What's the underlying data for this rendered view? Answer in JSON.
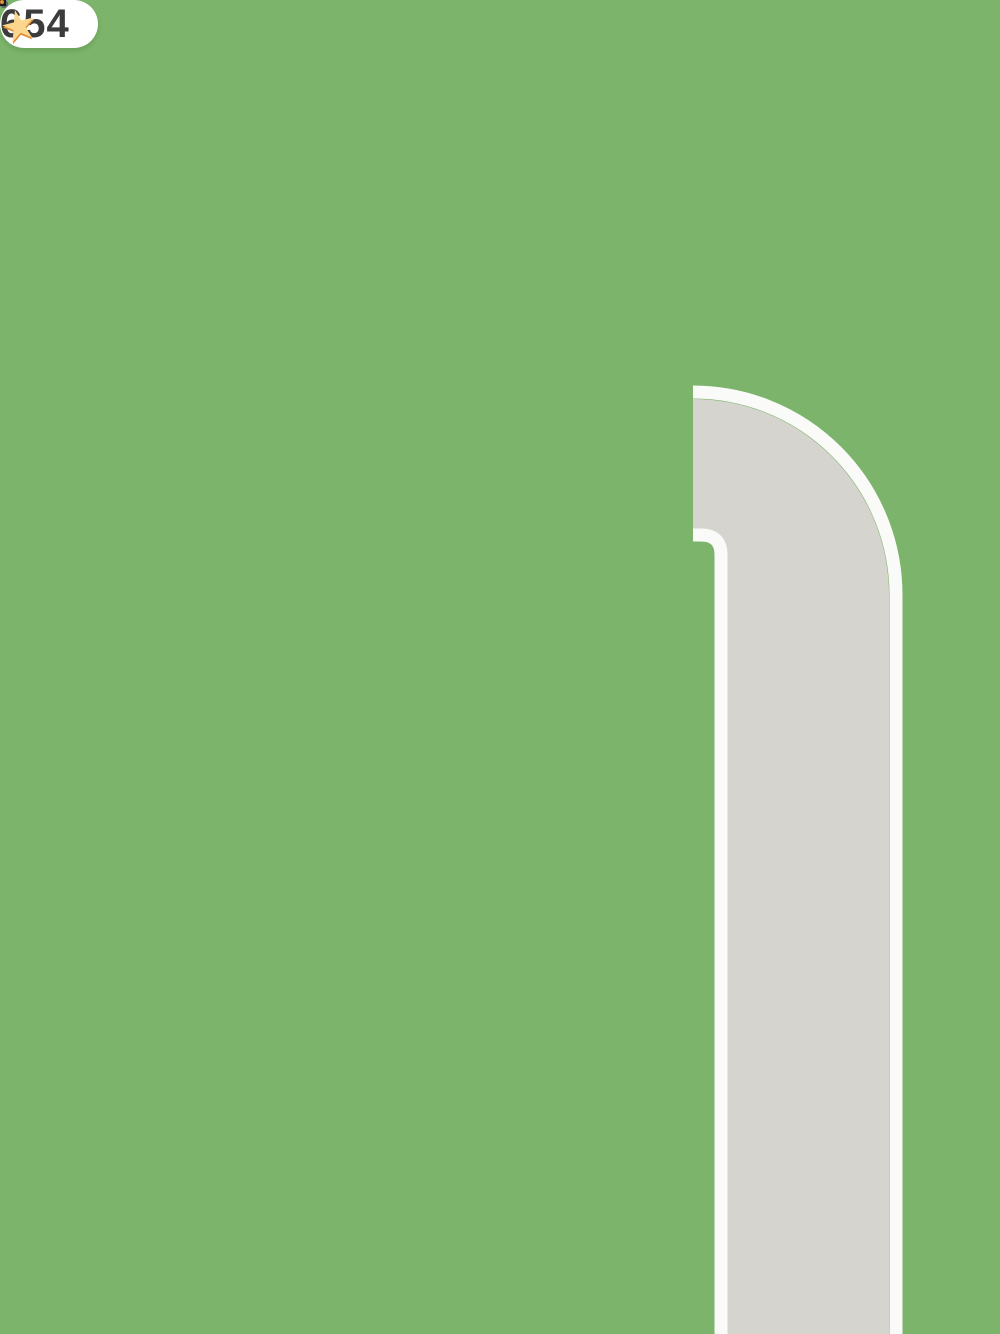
{
  "hud": {
    "coin_badge": {
      "count": "654",
      "icon": "star-coin",
      "badge_color": "#ffffff",
      "text_color": "#3c3c3c",
      "coin_color": "#f0a044",
      "star_color": "#fbd78e",
      "star_glyph": "★"
    }
  },
  "environment": {
    "grass_color": "#7bb46a",
    "road": {
      "asphalt": "#d6d4ce",
      "edge_line": "#fafaf8",
      "layout": "horizontal road segment on left, curved corner road running down right side"
    },
    "sidewalk": {
      "color": "#b28878",
      "edge": "#a97f6e"
    },
    "tree": {
      "canopy": "#549242",
      "trunk": "#7b5147"
    }
  },
  "building": {
    "type": "cafe-top-down",
    "wall": "#fdf6cf",
    "window_frame": "#f8e6c0",
    "window_glass": "#b1c6d4",
    "window_sill": "#fcf3d8",
    "roof_sign": "#f4c535",
    "floor_tan": "#e1c6a6",
    "floor_yellow": "#fbd78a",
    "floor_edge_yellow": "#f2ca7c",
    "counter_front": "#fde9a8",
    "service_counter_brown": "#7a4a28",
    "awning_stripes": [
      "#fcc858",
      "#f4f4f2"
    ]
  },
  "vehicles": {
    "red_car": {
      "body": "#e8635c",
      "glass": "#46a5a3",
      "taillights": "#f2ce3e",
      "bumper": "#564d43",
      "plate": "#f5d442"
    },
    "car_through_window": {
      "body": "#b6c086",
      "glass": "#4fa8bc",
      "wheels": "#93a0ab"
    }
  },
  "props": {
    "coffee_machines": {
      "count": 2,
      "body": "#4a4a4a",
      "tray": "#dcdcdc",
      "spout": "#a9a9a9"
    },
    "oven": {
      "top": "#8e8e8e",
      "band": "#2c2c2c",
      "door": "#515151",
      "handle": "#b5b5b5"
    },
    "tables": {
      "count": 2,
      "top": "#f4f4f4",
      "front": "#b9b9b9"
    },
    "coffee_cup_icon": {
      "body": "#e08a33",
      "lid": "#4a3121",
      "rim": "#f7ead3",
      "outline": "#1d1d1d"
    },
    "coffee_cup_3d": {
      "body": "#f4efe6",
      "band": "#e09040",
      "lid": "#6f4c34"
    },
    "croissant_icon": {
      "center": "#f8cda5",
      "sides": "#f5b277",
      "outline": "#1d1d1d"
    },
    "muffin_icon": {
      "top": "#a8662e",
      "chips": "#4f2d12",
      "wrapper_light": "#ef8397",
      "wrapper_dark": "#c24459"
    },
    "held_muffin": {
      "top": "#ed9434",
      "chips": "#8a5a22",
      "wrapper": "#f0609c"
    }
  },
  "characters": {
    "workers": [
      {
        "id": "worker-at-counter",
        "uniform": "#f4dc3a",
        "cap_crown": "#f6e33c",
        "cap_brim": "#f3493a",
        "hair": "#503524"
      },
      {
        "id": "worker-left",
        "uniform": "#f4dc3a",
        "cap_crown": "#f6e33c",
        "cap_brim": "#f3493a",
        "hair": "#503524"
      },
      {
        "id": "worker-with-coffee",
        "uniform": "#f4dc3a",
        "cap_crown": "#f6e33c",
        "cap_brim": "#f3493a",
        "hair": "#503524"
      }
    ],
    "customers": [
      {
        "id": "customer-orange-hair",
        "hair": "#d9832f",
        "shirt": "#6fb6e9",
        "earrings": "#f3c23e"
      },
      {
        "id": "customer-blue-cap",
        "cap": "#2d9de2",
        "shirt": "#2a86cc",
        "straps": "#f4f6f8"
      },
      {
        "id": "customer-straw-hat",
        "hat": "#eee5bf",
        "hat_band": "#e8495a",
        "shirt": "#f4f1ea"
      },
      {
        "id": "customer-sun-hat-with-muffin",
        "hat": "#f1ebc8",
        "shirt": "#3ea142",
        "pants": "#2f7d33",
        "sandals": "#2e2e2e"
      }
    ],
    "pedestrian": {
      "id": "elderly-lady",
      "hair": "#9d9d9b",
      "outfit": "#ec5f92",
      "shoes": "#f06fa0"
    }
  }
}
